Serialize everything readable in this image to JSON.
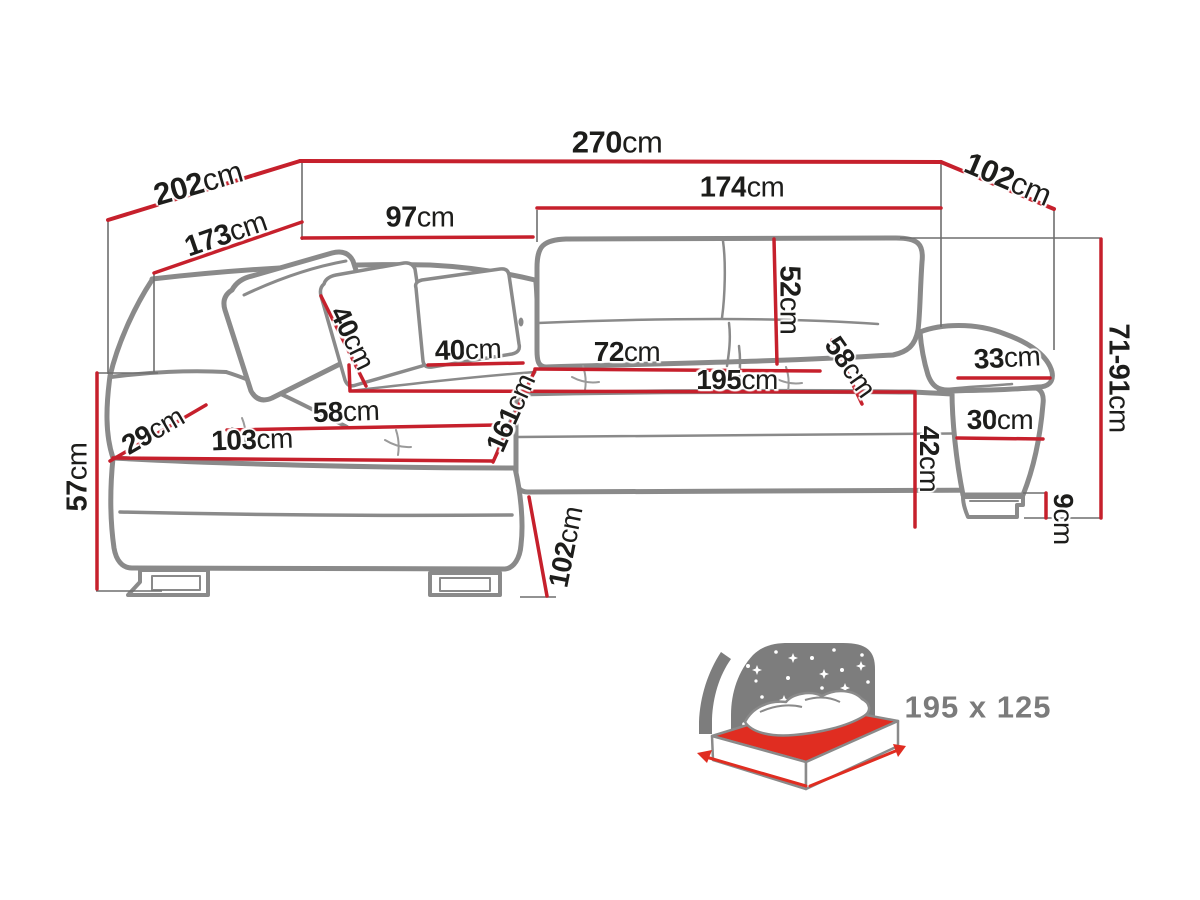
{
  "colors": {
    "dimension_red": "#c6202c",
    "outline_gray": "#8a8a8a",
    "extension_gray": "#6e6e6e",
    "text_black": "#1d1d1b",
    "icon_gray": "#7b7b7b",
    "mattress_red": "#e02d21",
    "background": "#ffffff"
  },
  "dims": {
    "w270": {
      "v": "270",
      "u": "cm"
    },
    "w202": {
      "v": "202",
      "u": "cm"
    },
    "w102": {
      "v": "102",
      "u": "cm"
    },
    "w173": {
      "v": "173",
      "u": "cm"
    },
    "w97": {
      "v": "97",
      "u": "cm"
    },
    "w174": {
      "v": "174",
      "u": "cm"
    },
    "h52": {
      "v": "52",
      "u": "cm"
    },
    "p40a": {
      "v": "40",
      "u": "cm"
    },
    "p40b": {
      "v": "40",
      "u": "cm"
    },
    "d72": {
      "v": "72",
      "u": "cm"
    },
    "l195": {
      "v": "195",
      "u": "cm"
    },
    "d58r": {
      "v": "58",
      "u": "cm"
    },
    "w33": {
      "v": "33",
      "u": "cm"
    },
    "w30": {
      "v": "30",
      "u": "cm"
    },
    "h7191": {
      "v": "71-91",
      "u": "cm"
    },
    "h42": {
      "v": "42",
      "u": "cm"
    },
    "h9": {
      "v": "9",
      "u": "cm"
    },
    "d58l": {
      "v": "58",
      "u": "cm"
    },
    "w103": {
      "v": "103",
      "u": "cm"
    },
    "w29": {
      "v": "29",
      "u": "cm"
    },
    "l161": {
      "v": "161",
      "u": "cm"
    },
    "h57": {
      "v": "57",
      "u": "cm"
    },
    "d102": {
      "v": "102",
      "u": "cm"
    }
  },
  "sleeping_area": {
    "size": "195 x 125"
  }
}
